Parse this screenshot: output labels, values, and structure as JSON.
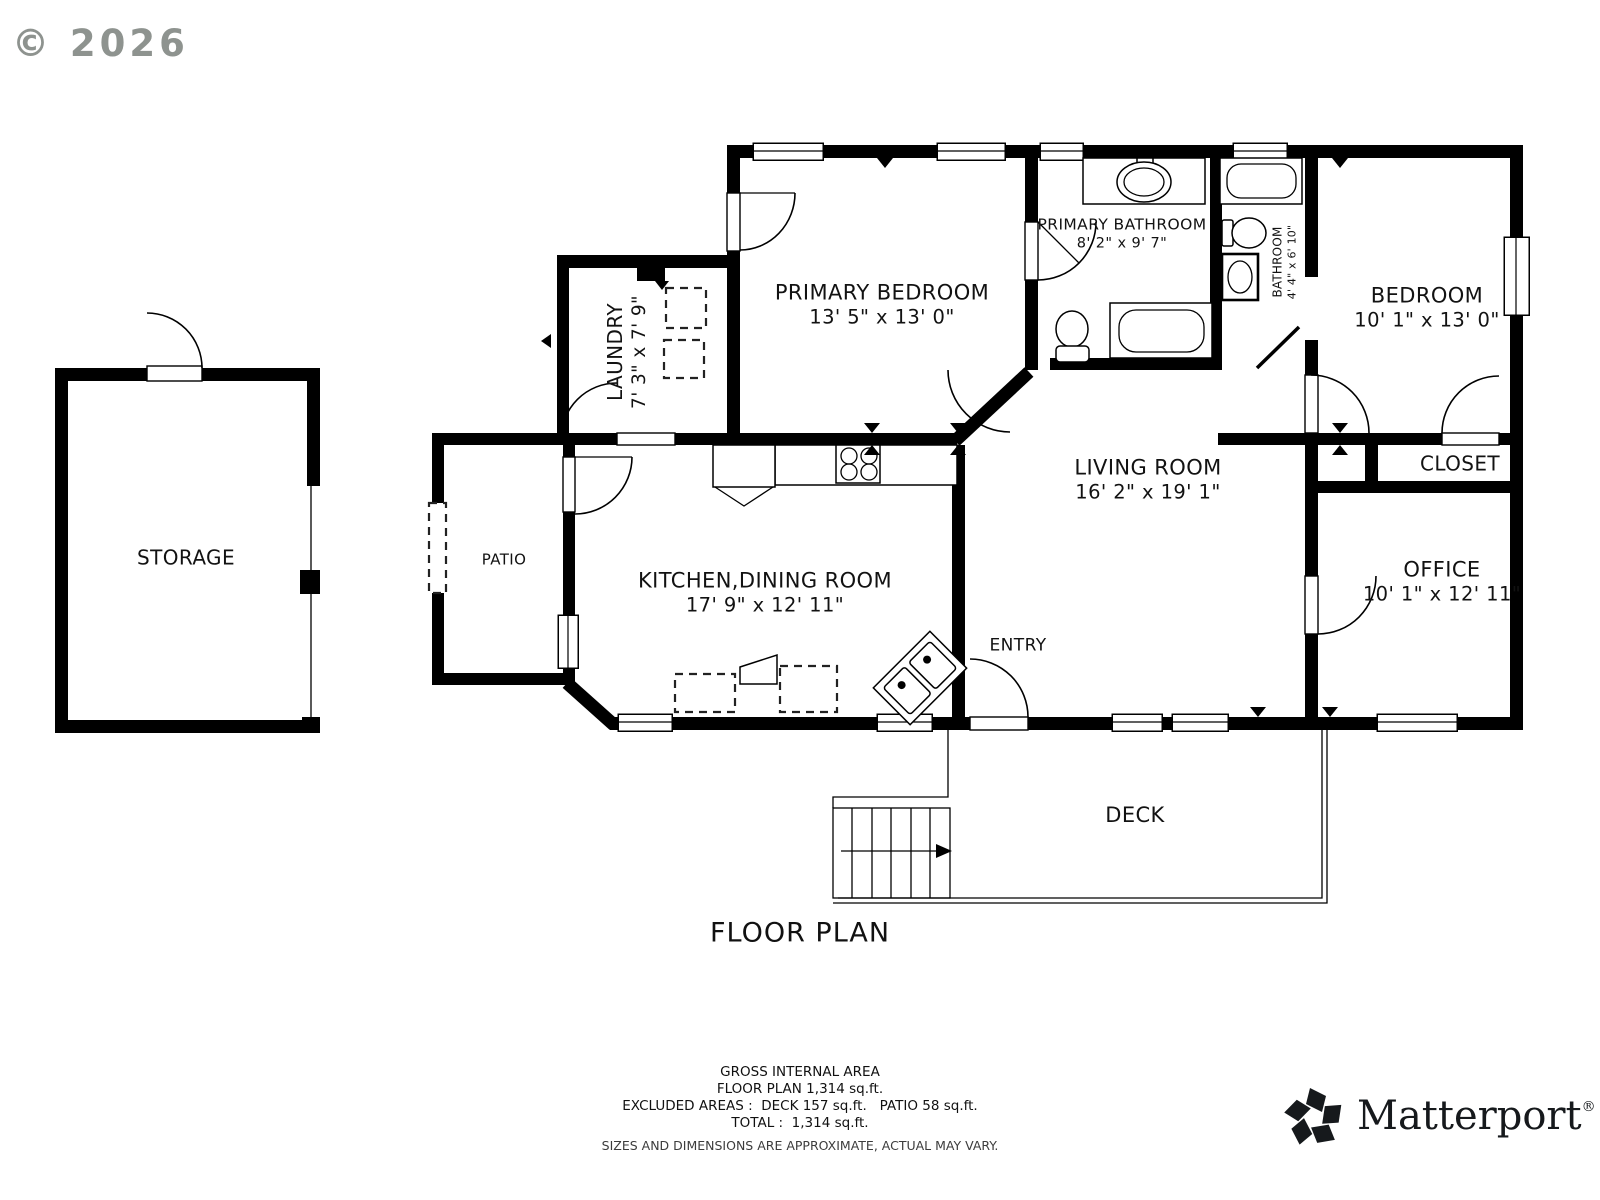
{
  "copyright": "© 2026",
  "title": "FLOOR PLAN",
  "rooms": {
    "storage": {
      "name": "STORAGE"
    },
    "patio": {
      "name": "PATIO"
    },
    "laundry": {
      "name": "LAUNDRY",
      "dims": "7' 3\" x 7' 9\""
    },
    "kitchen_dining": {
      "name": "KITCHEN,DINING ROOM",
      "dims": "17' 9\" x 12' 11\""
    },
    "primary_bedroom": {
      "name": "PRIMARY BEDROOM",
      "dims": "13' 5\" x 13' 0\""
    },
    "primary_bathroom": {
      "name": "PRIMARY BATHROOM",
      "dims": "8' 2\" x 9' 7\""
    },
    "bathroom": {
      "name": "BATHROOM",
      "dims": "4' 4\" x 6' 10\""
    },
    "bedroom": {
      "name": "BEDROOM",
      "dims": "10' 1\" x 13' 0\""
    },
    "closet": {
      "name": "CLOSET"
    },
    "living_room": {
      "name": "LIVING ROOM",
      "dims": "16' 2\" x 19' 1\""
    },
    "office": {
      "name": "OFFICE",
      "dims": "10' 1\" x 12' 11\""
    },
    "entry": {
      "name": "ENTRY"
    },
    "deck": {
      "name": "DECK"
    }
  },
  "summary": {
    "line1": "GROSS INTERNAL AREA",
    "line2": "FLOOR PLAN 1,314 sq.ft.",
    "line3": "EXCLUDED AREAS :  DECK 157 sq.ft.   PATIO 58 sq.ft.",
    "line4": "TOTAL :  1,314 sq.ft.",
    "disclaimer": "SIZES AND DIMENSIONS ARE APPROXIMATE, ACTUAL MAY VARY."
  },
  "branding": {
    "name": "Matterport",
    "mark": "®"
  },
  "colors": {
    "wall": "#000000",
    "copyright_gray": "#8e938f",
    "disclaimer_gray": "#3c3c3c"
  }
}
